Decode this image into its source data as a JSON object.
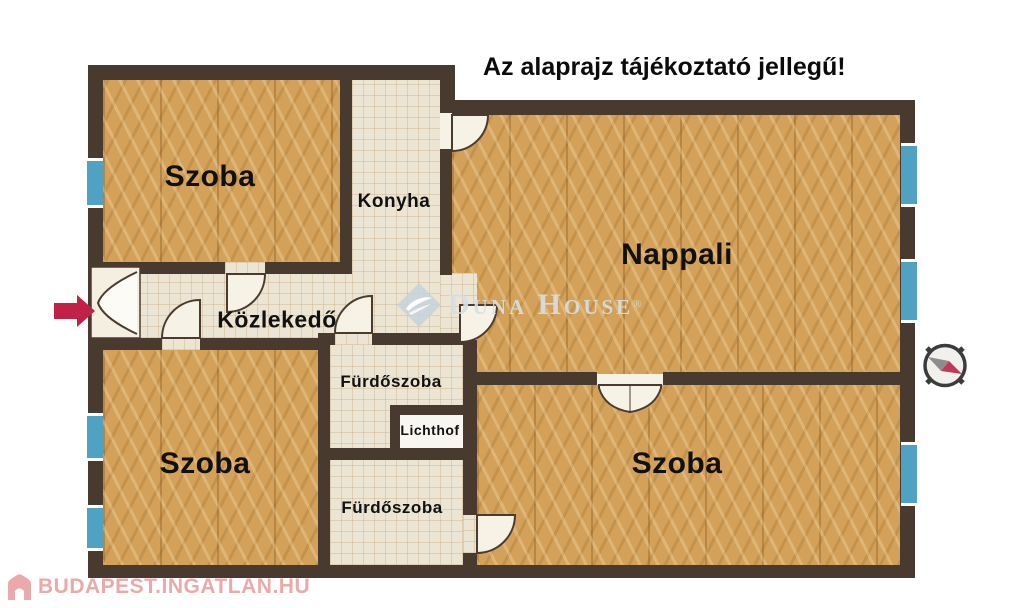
{
  "title": "Az alaprajz tájékoztató jellegű!",
  "rooms": {
    "szoba_top_left": "Szoba",
    "konyha": "Konyha",
    "nappali": "Nappali",
    "kozlekedo": "Közlekedő",
    "furdoszoba_upper": "Fürdőszoba",
    "lichthof": "Lichthof",
    "furdoszoba_lower": "Fürdőszoba",
    "szoba_bottom_left": "Szoba",
    "szoba_bottom_right": "Szoba"
  },
  "watermark": {
    "brand": "Duna House",
    "registered": "®"
  },
  "footer_logo": {
    "text": "BUDAPEST.INGATLAN.HU"
  },
  "colors": {
    "wall": "#493a30",
    "wood_floor": "#d3a159",
    "tile_floor": "#ede5d3",
    "window": "#4fa2c2",
    "entrance_arrow": "#c22147",
    "watermark_text": "#d5dee2",
    "footer_pink": "#eba9a9",
    "label_text": "#111111"
  }
}
